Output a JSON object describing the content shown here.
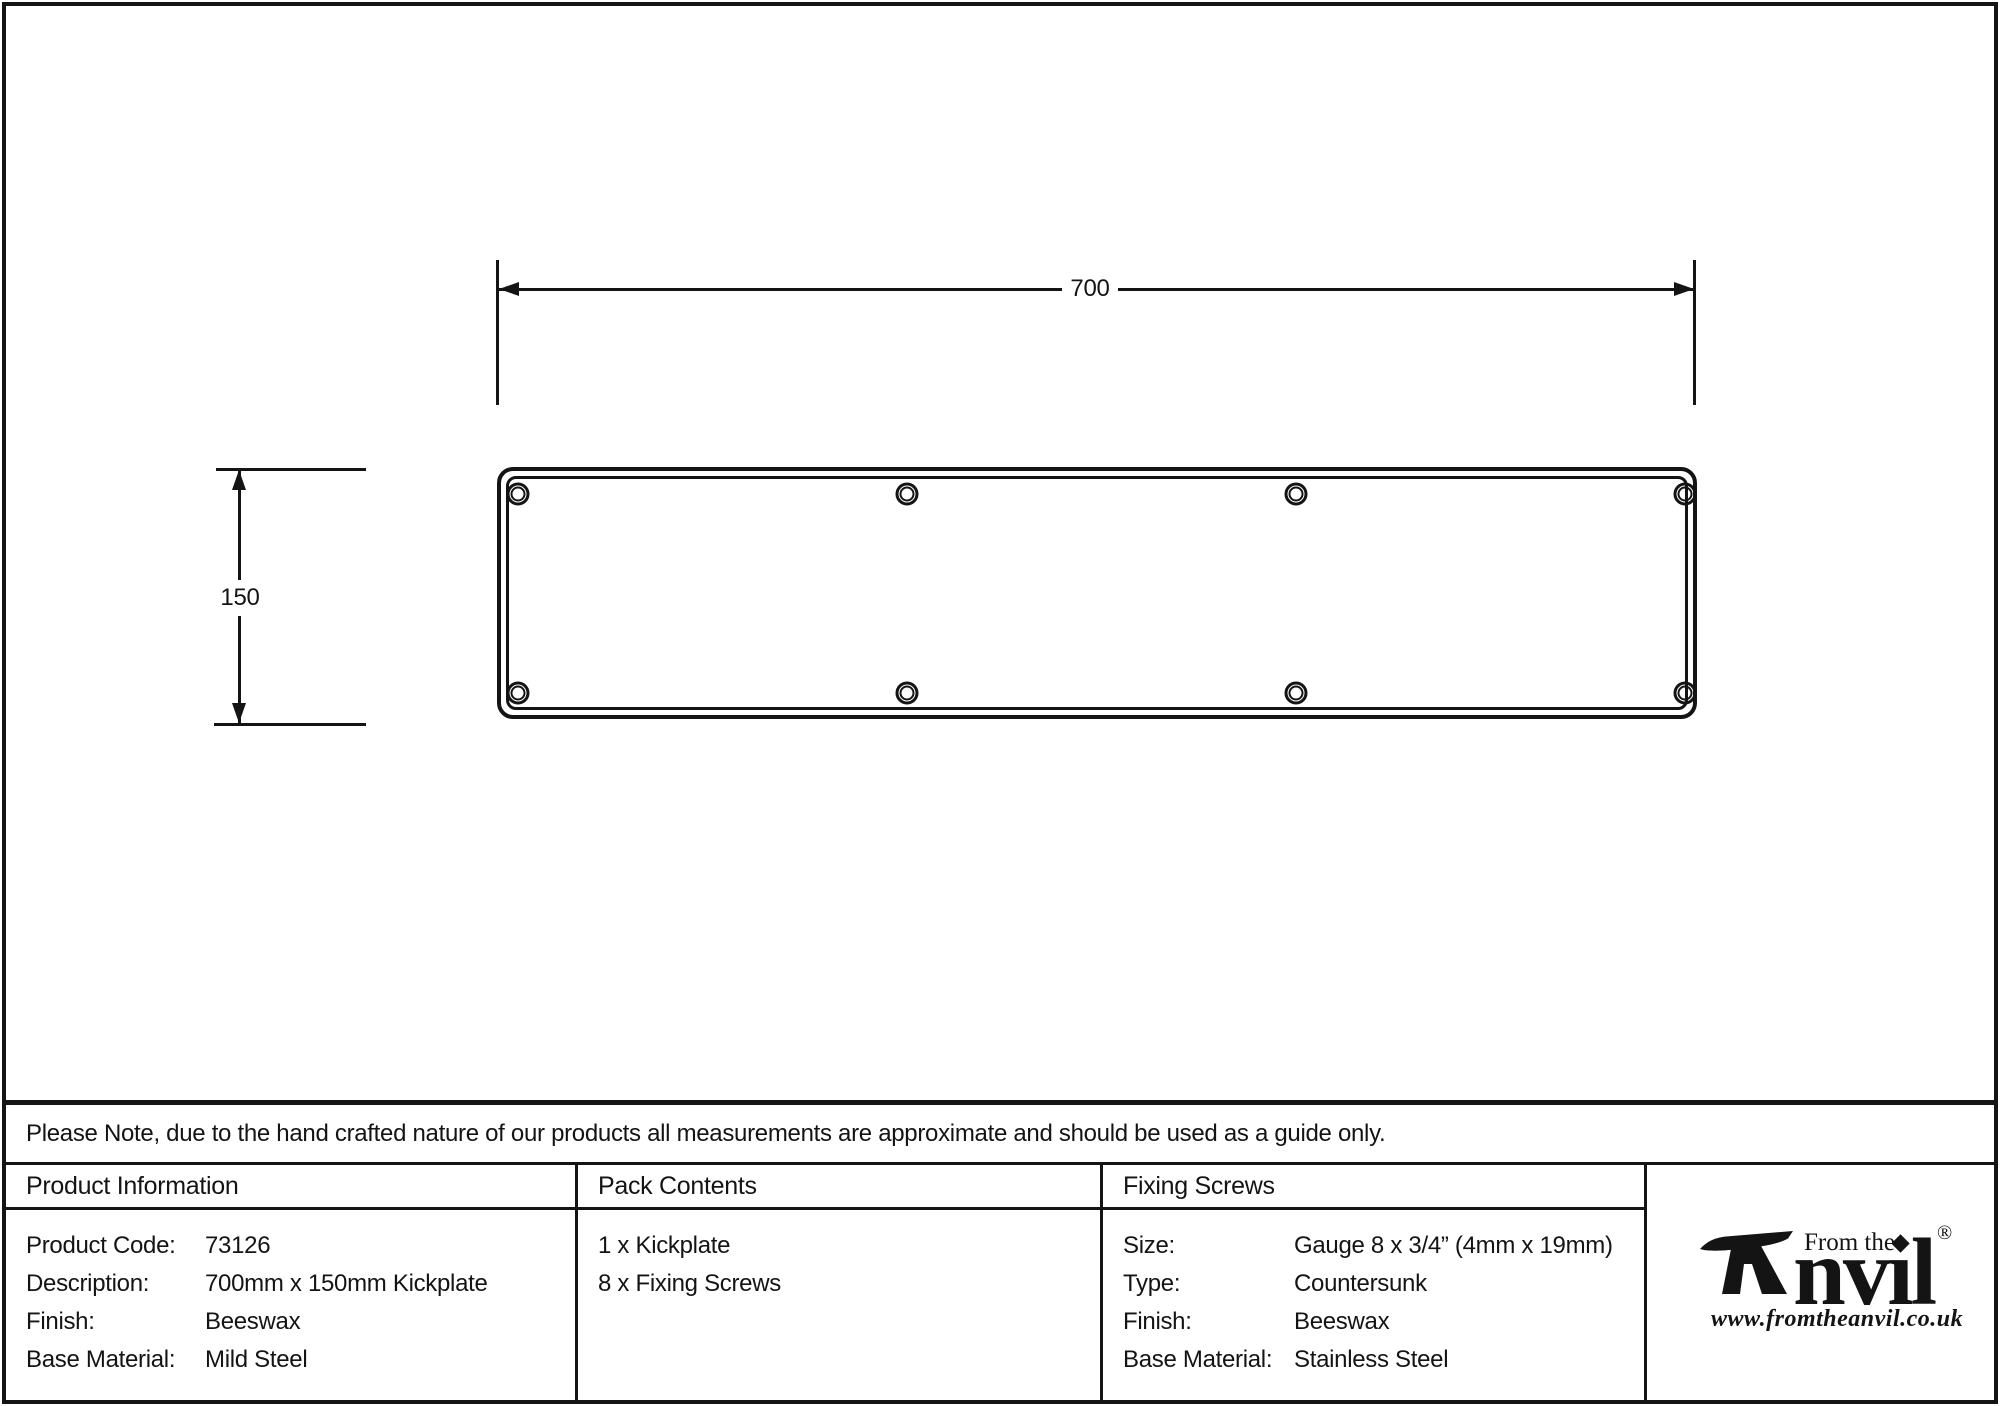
{
  "drawing": {
    "width_dim_label": "700",
    "height_dim_label": "150"
  },
  "note": "Please Note, due to the hand crafted nature of our products all measurements are approximate and should be used as a guide only.",
  "table": {
    "product_information": {
      "header": "Product Information",
      "rows": [
        {
          "label": "Product Code:",
          "value": "73126"
        },
        {
          "label": "Description:",
          "value": "700mm x 150mm Kickplate"
        },
        {
          "label": "Finish:",
          "value": "Beeswax"
        },
        {
          "label": "Base Material:",
          "value": "Mild Steel"
        }
      ]
    },
    "pack_contents": {
      "header": "Pack Contents",
      "items": [
        "1 x Kickplate",
        "8 x Fixing Screws"
      ]
    },
    "fixing_screws": {
      "header": "Fixing Screws",
      "rows": [
        {
          "label": "Size:",
          "value": "Gauge 8 x 3/4” (4mm x 19mm)"
        },
        {
          "label": "Type:",
          "value": "Countersunk"
        },
        {
          "label": "Finish:",
          "value": "Beeswax"
        },
        {
          "label": "Base Material:",
          "value": "Stainless Steel"
        }
      ]
    }
  },
  "logo": {
    "tagline": "From the",
    "brand": "Anvil",
    "registered": "®",
    "website": "www.fromtheanvil.co.uk"
  },
  "colors": {
    "ink": "#141414",
    "background": "#ffffff"
  }
}
